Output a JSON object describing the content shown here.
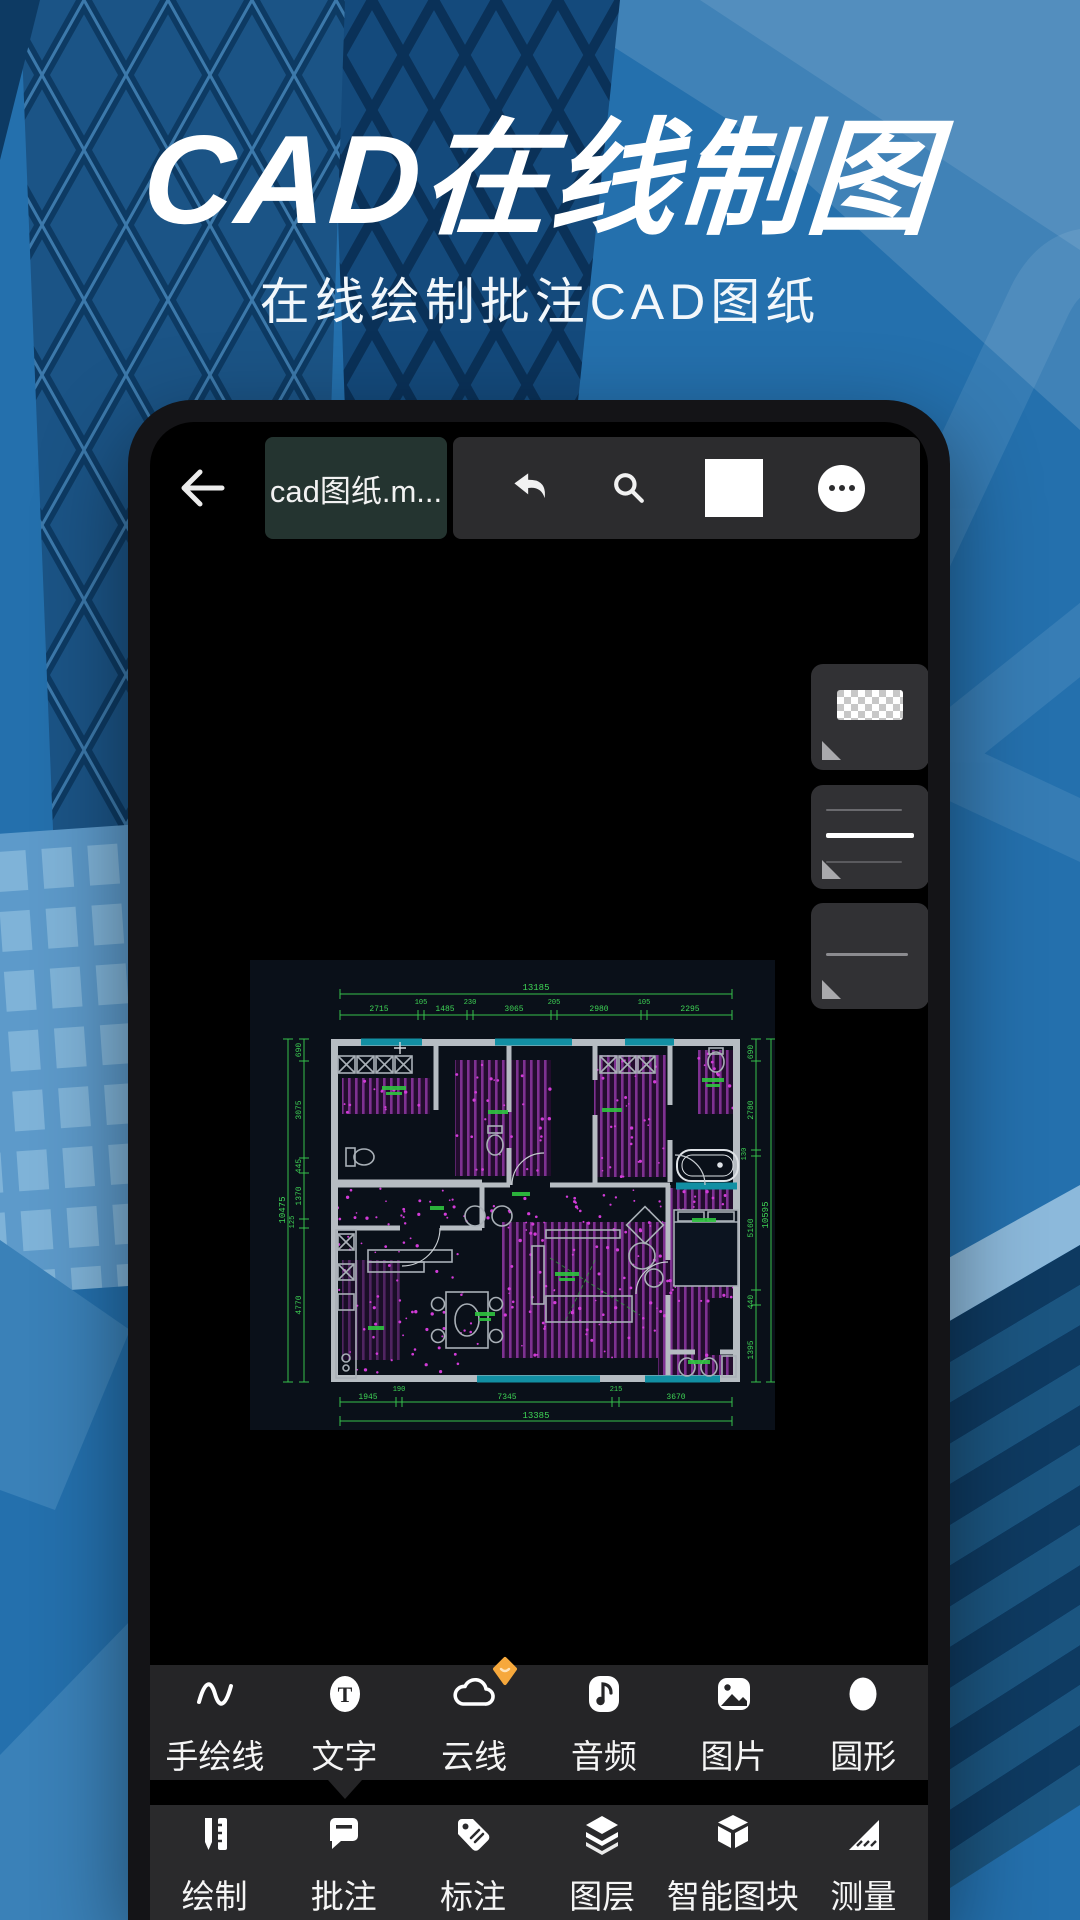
{
  "hero": {
    "title": "CAD在线制图",
    "subtitle": "在线绘制批注CAD图纸"
  },
  "phone": {
    "topbar": {
      "filename": "cad图纸.m...",
      "icons": [
        "back-arrow-icon",
        "undo-icon",
        "search-icon",
        "color-swatch",
        "more-icon"
      ]
    },
    "style_panels": [
      {
        "name": "transparency-pattern-swatch"
      },
      {
        "name": "line-width-options"
      },
      {
        "name": "thin-line-option"
      }
    ],
    "cad_drawing": {
      "dims_top_overall": "13185",
      "dims_top": [
        "2715",
        "105",
        "1485",
        "230",
        "3065",
        "205",
        "2980",
        "105",
        "2295"
      ],
      "dims_bottom": [
        "1945",
        "190",
        "7345",
        "215",
        "3670"
      ],
      "dims_bottom_overall": "13385",
      "dims_left": [
        "690",
        "3075",
        "445",
        "1370",
        "125",
        "4770"
      ],
      "dims_left_overall": "10475",
      "dims_right": [
        "690",
        "2780",
        "130",
        "5160",
        "440",
        "1395"
      ],
      "dims_right_overall": "10595"
    },
    "annotate_toolbar": {
      "items": [
        {
          "label": "手绘线",
          "icon": "freehand-line-icon"
        },
        {
          "label": "文字",
          "icon": "text-icon",
          "glyph": "T"
        },
        {
          "label": "云线",
          "icon": "cloud-line-icon",
          "badge": "vip-gem-badge"
        },
        {
          "label": "音频",
          "icon": "audio-icon"
        },
        {
          "label": "图片",
          "icon": "image-icon"
        },
        {
          "label": "圆形",
          "icon": "circle-shape-icon"
        }
      ]
    },
    "main_toolbar": {
      "items": [
        {
          "label": "绘制",
          "icon": "draw-icon"
        },
        {
          "label": "批注",
          "icon": "annotate-icon"
        },
        {
          "label": "标注",
          "icon": "dimension-tag-icon"
        },
        {
          "label": "图层",
          "icon": "layers-icon"
        },
        {
          "label": "智能图块",
          "icon": "smart-block-icon"
        },
        {
          "label": "测量",
          "icon": "measure-icon"
        }
      ]
    }
  },
  "colors": {
    "background_blue": "#2470ad",
    "light_blue_accent": "#4a8cc0",
    "tower_navy": "#0d3a63",
    "popup_bg": "#252527",
    "toolbar_bg": "#2a2a2c",
    "panel_bg": "#313134",
    "chip_bg": "#243430",
    "cad_green": "#3ed455",
    "cad_magenta": "#d23bd8",
    "cad_purple": "#7e3191",
    "cad_teal": "#128fa3",
    "badge_orange": "#f6a83c"
  }
}
